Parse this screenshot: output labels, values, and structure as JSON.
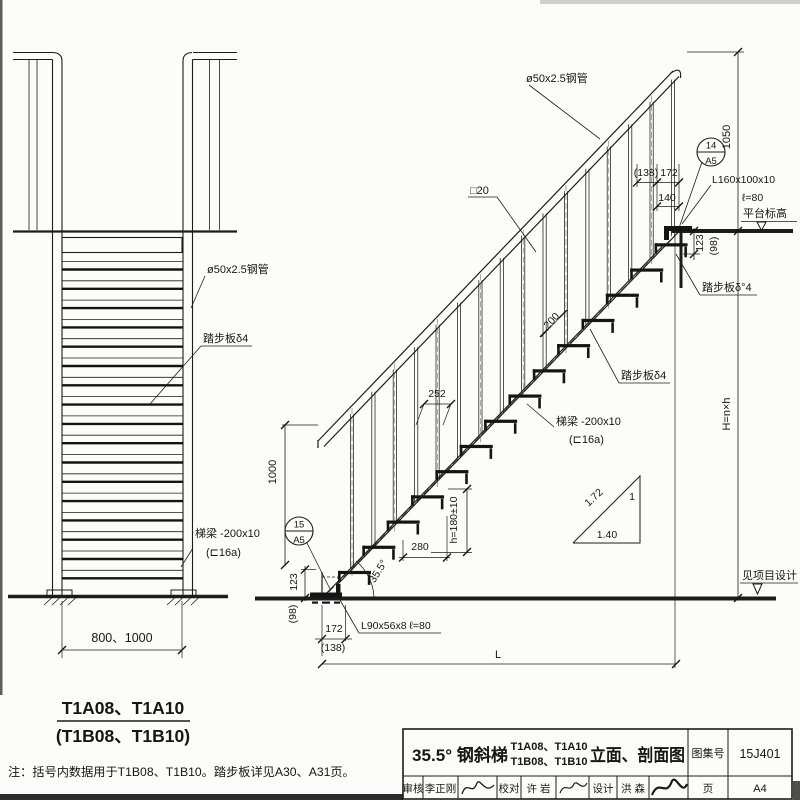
{
  "drawing": {
    "left_view": {
      "pipe_label": "ø50x2.5钢管",
      "tread_label": "踏步板δ4",
      "beam_label": "梯梁 -200x10",
      "beam_size": "(⊏16a)",
      "width_dim": "800、1000",
      "model_title": "T1A08、T1A10",
      "model_title_alt": "(T1B08、T1B10)"
    },
    "right_view": {
      "pipe_label": "ø50x2.5钢管",
      "baluster_label": "□20",
      "platform_angle_label": "L160x100x10",
      "platform_angle_len": "ℓ=80",
      "platform_level_label": "平台标高",
      "tread_label_top": "踏步板δ°4",
      "tread_label_mid": "踏步板δ4",
      "beam_label": "梯梁 -200x10",
      "beam_size": "(⊏16a)",
      "base_angle_label": "L90x56x8  ℓ=80",
      "ground_level_label": "见项目设计",
      "dims": {
        "rail_height_top": "1050",
        "top_alt": "(138)",
        "top": "172",
        "top_inner": "140",
        "platform_drop": "123",
        "platform_drop_alt": "(98)",
        "rail_spacing": "200",
        "tread_spacing": "252",
        "tread_run": "280",
        "riser": "h=180±10",
        "rail_height_bottom": "1000",
        "base_drop": "123",
        "base_drop_alt": "(98)",
        "base_offset": "172",
        "base_offset_alt": "(138)",
        "total_run": "L",
        "total_height": "H=n×h",
        "slope_angle": "35.5°"
      },
      "slope_triangle": {
        "hypotenuse": "1.72",
        "vertical": "1",
        "horizontal": "1.40"
      },
      "detail_top": {
        "number": "14",
        "sheet": "A5"
      },
      "detail_bottom": {
        "number": "15",
        "sheet": "A5"
      }
    },
    "note": "注：括号内数据用于T1B08、T1B10。踏步板详见A30、A31页。",
    "structure": {
      "left_tread_rows": 17,
      "right_treads": 14,
      "right_balusters": 16
    }
  },
  "title_block": {
    "product_angle_title": "35.5° 钢斜梯",
    "models_line1": "T1A08、T1A10",
    "models_line2": "T1B08、T1B10",
    "view_title": "立面、剖面图",
    "atlas_label": "图集号",
    "atlas_number": "15J401",
    "page_label": "页",
    "page_number": "A4",
    "reviewer_label": "审核",
    "reviewer_name": "李正刚",
    "checker_label": "校对",
    "checker_name": "许 岩",
    "designer_label": "设计",
    "designer_name": "洪 森"
  }
}
